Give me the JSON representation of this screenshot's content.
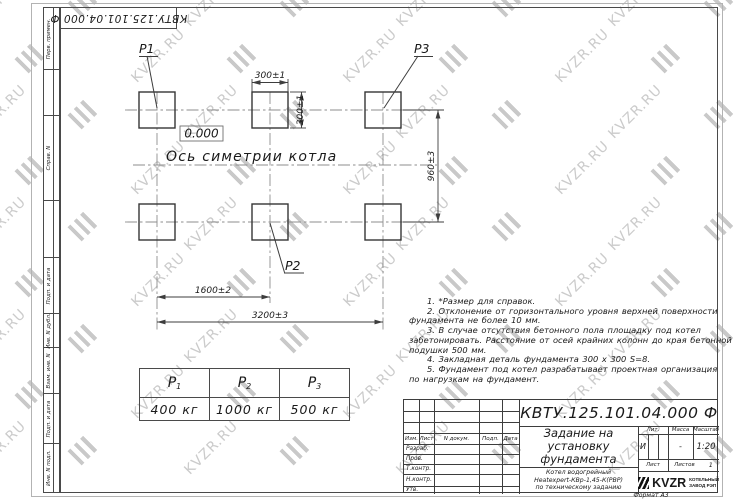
{
  "watermark": {
    "text": "KVZR.RU",
    "color": "#cbcbcb"
  },
  "margin_column": {
    "labels": [
      "Перв. примен.",
      "Справ. N",
      "Подп. и дата",
      "Инв. N дубл.",
      "Взам. инв. N",
      "Подп. и дата",
      "Инв. N подл."
    ]
  },
  "drawing": {
    "pads": [
      "P1",
      "P2",
      "P3"
    ],
    "elevation_mark": "0.000",
    "axis_label": "Ось симетрии котла",
    "dimensions": {
      "pad_width": "300±1",
      "pad_height": "300±1",
      "row_spacing": "960±3",
      "col_spacing": "1600±2",
      "total_span": "3200±3"
    }
  },
  "notes": {
    "lines": [
      "1. *Размер для справок.",
      "2. Отклонение от горизонтального уровня верхней поверхности",
      "фундамента не более 10 мм.",
      "3. В случае отсутствия бетонного пола площадку под котел",
      "забетонировать. Расстояние от осей крайних колонн до края бетонной",
      "подушки 500 мм.",
      "4. Закладная деталь фундамента 300 x 300 S=8.",
      "5. Фундамент под котел разрабатывает проектная организация",
      "по нагрузкам на фундамент."
    ]
  },
  "load_table": {
    "columns": [
      {
        "symbol": "Р",
        "sub": "1",
        "value": "400 кг"
      },
      {
        "symbol": "Р",
        "sub": "2",
        "value": "1000 кг"
      },
      {
        "symbol": "Р",
        "sub": "3",
        "value": "500 кг"
      }
    ]
  },
  "title_block": {
    "doc_number": "КВТУ.125.101.04.000  Ф",
    "title_lines": [
      "Задание на",
      "установку",
      "фундамента"
    ],
    "subtitle_lines": [
      "Котел водогрейный",
      "Heatexpert-КВр-1,45-К(РВР)",
      "по техническому заданию"
    ],
    "revision_header": [
      "Изм.",
      "Лист",
      "N докум.",
      "Подп.",
      "Дата"
    ],
    "role_rows": [
      "Разраб.",
      "Пров.",
      "Т.контр.",
      "Н.контр.",
      "Утв."
    ],
    "lit": {
      "label": "Лит.",
      "value": "И"
    },
    "mass": {
      "label": "Масса",
      "value": "-"
    },
    "scale": {
      "label": "Масштаб",
      "value": "1:20"
    },
    "sheet": {
      "label": "Лист"
    },
    "sheets": {
      "label": "Листов",
      "value": "1"
    },
    "logo": {
      "name": "KVZR",
      "caption_lines": [
        "КОТЕЛЬНЫЙ",
        "ЗАВОД РЭП"
      ]
    },
    "format_label": "Формат А3"
  }
}
